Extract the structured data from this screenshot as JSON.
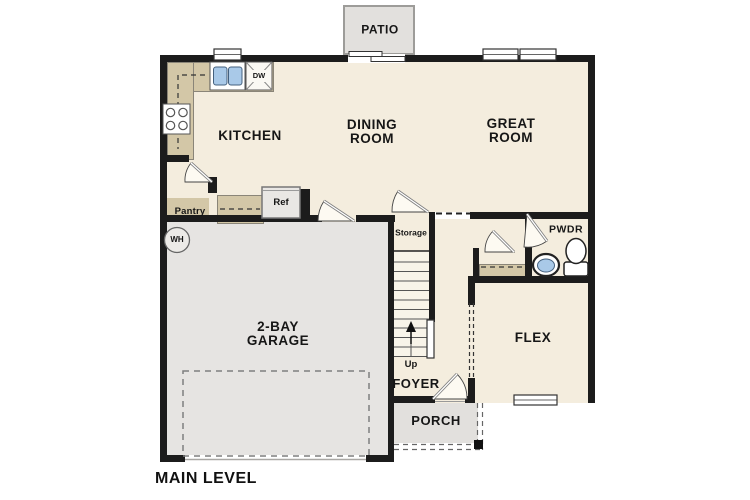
{
  "plan_title": "MAIN LEVEL",
  "rooms": {
    "kitchen": "KITCHEN",
    "dining_line1": "DINING",
    "dining_line2": "ROOM",
    "great_line1": "GREAT",
    "great_line2": "ROOM",
    "garage_line1": "2-BAY",
    "garage_line2": "GARAGE",
    "flex": "FLEX",
    "foyer": "FOYER",
    "powder": "PWDR",
    "pantry": "Pantry",
    "storage": "Storage"
  },
  "outdoor": {
    "patio": "PATIO",
    "porch": "PORCH"
  },
  "fixtures": {
    "dishwasher": "DW",
    "refrigerator": "Ref",
    "water_heater": "WH"
  },
  "stairs": {
    "direction": "Up"
  },
  "colors": {
    "paper": "#ffffff",
    "wall": "#1c1c1c",
    "floor": "#f4edde",
    "garage": "#e6e4e2",
    "outdoor": "#e2e0dd",
    "counter": "#d3c7a7",
    "water": "#a9c9e8",
    "line": "#555555"
  }
}
